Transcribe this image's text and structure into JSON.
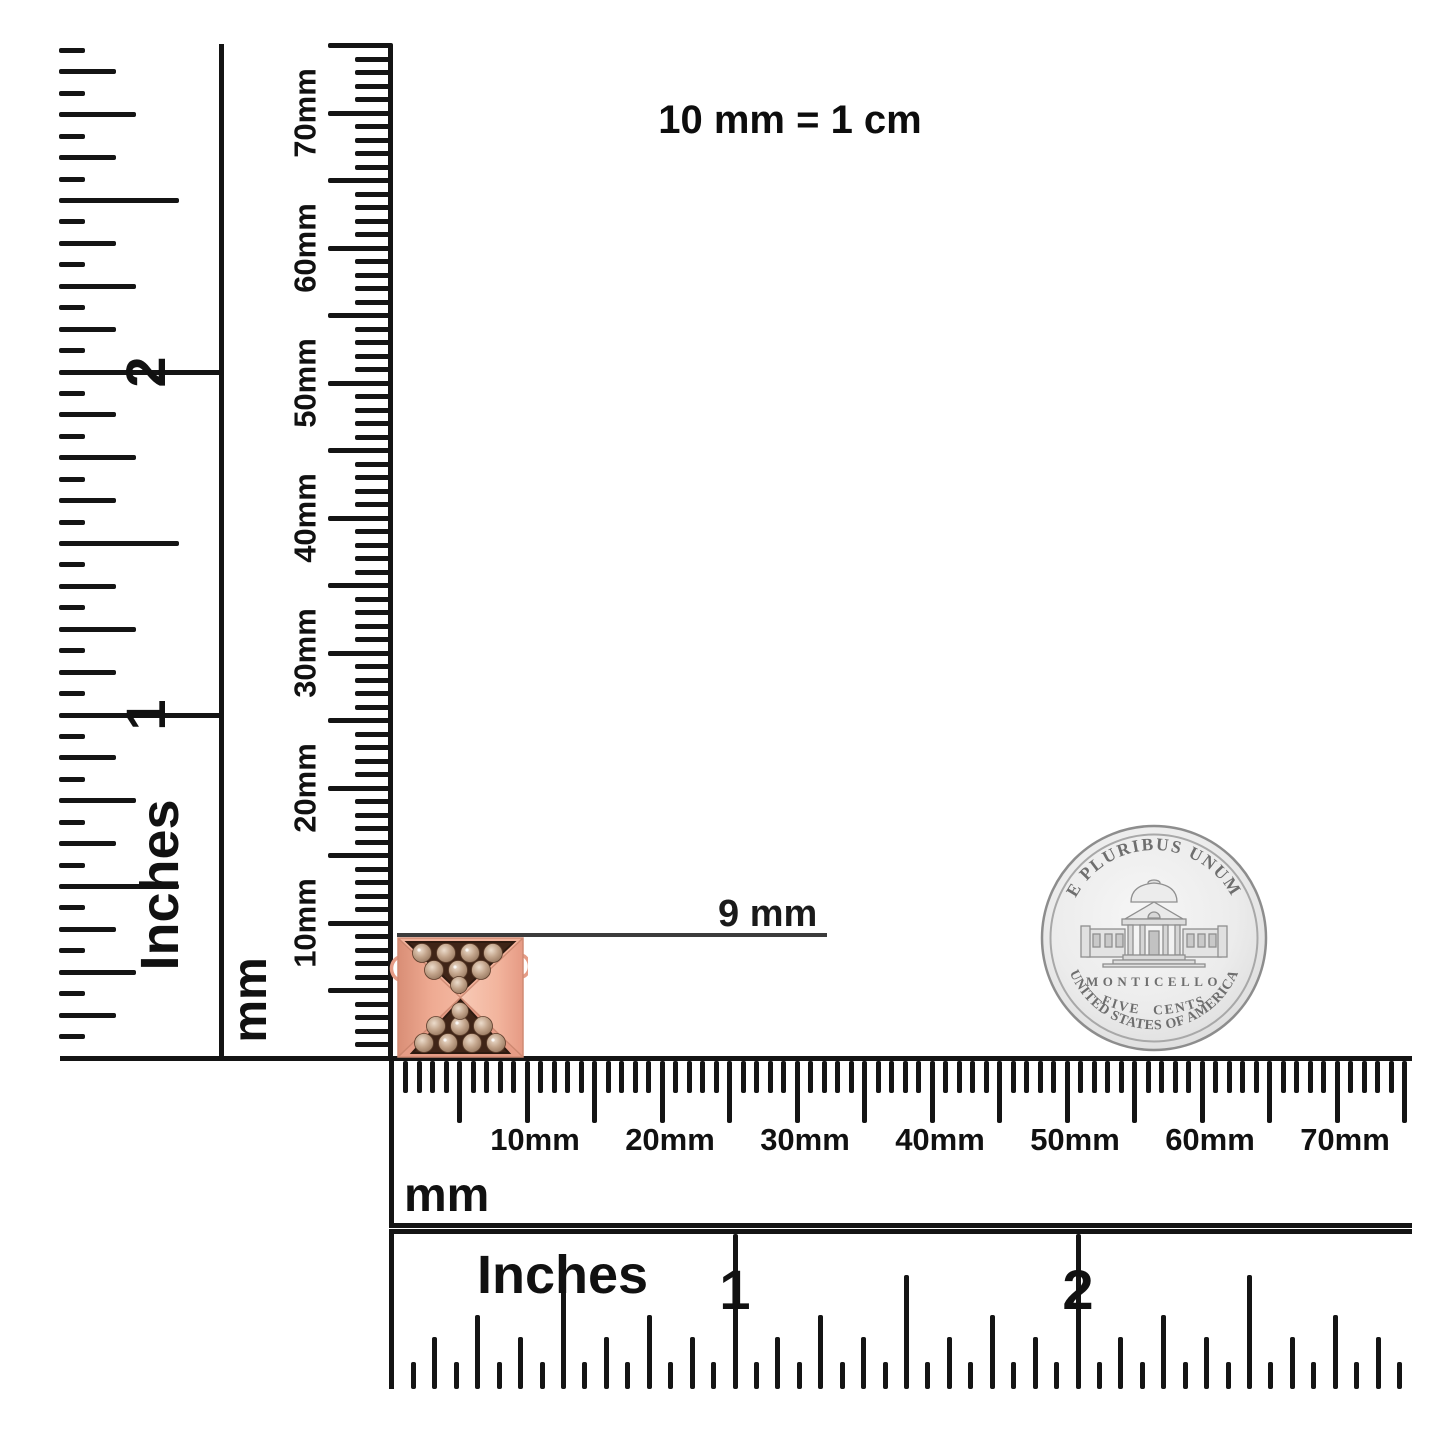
{
  "scale_note": "10 mm = 1 cm",
  "measurement": {
    "value": "9 mm"
  },
  "rulers": {
    "vertical_inches": {
      "unit": "Inches",
      "numerals": [
        "1",
        "2"
      ]
    },
    "vertical_mm": {
      "unit": "mm",
      "labels": [
        "10mm",
        "20mm",
        "30mm",
        "40mm",
        "50mm",
        "60mm",
        "70mm"
      ]
    },
    "horizontal_mm": {
      "unit": "mm",
      "labels": [
        "10mm",
        "20mm",
        "30mm",
        "40mm",
        "50mm",
        "60mm",
        "70mm"
      ]
    },
    "horizontal_inches": {
      "unit": "Inches",
      "numerals": [
        "1",
        "2"
      ]
    }
  },
  "coin": {
    "motto": "E PLURIBUS UNUM",
    "building": "MONTICELLO",
    "denomination": "FIVE CENTS",
    "country": "UNITED STATES OF AMERICA"
  },
  "item_colors": {
    "rose_gold": "#efab94",
    "rose_gold_light": "#f7c6b2",
    "rose_gold_dark": "#dd9078",
    "pave_background": "#3f2417",
    "diamond": "#c8ab94",
    "coin_silver": "#e6e6e6",
    "ink": "#141414"
  }
}
